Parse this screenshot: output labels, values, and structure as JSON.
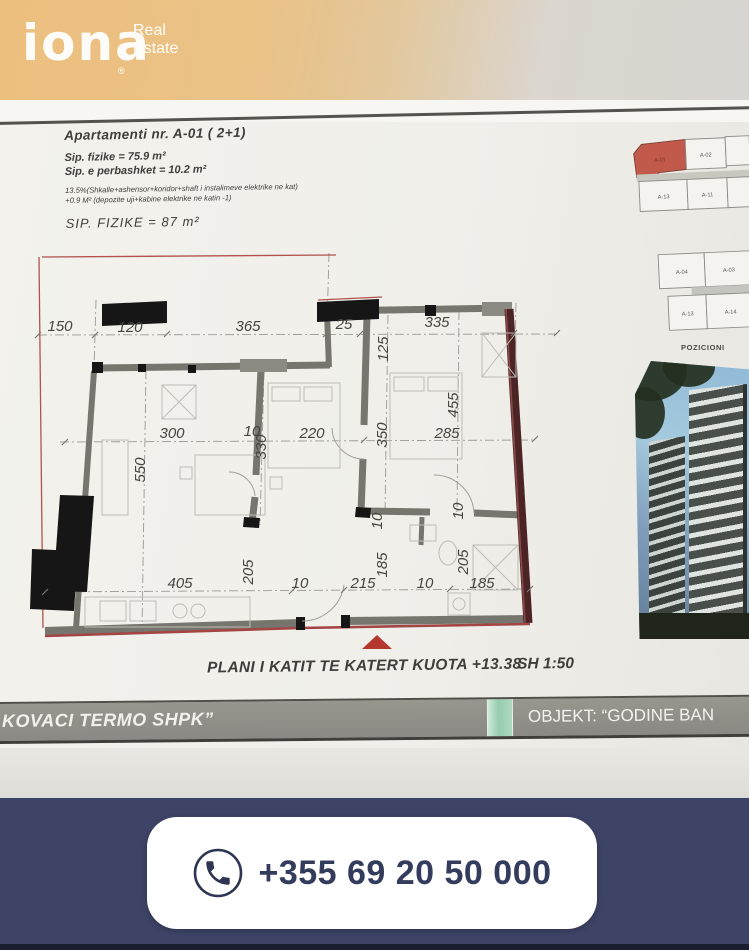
{
  "brand": {
    "logo": "iona",
    "reg": "®",
    "tag1": "Real",
    "tag2": "Estate"
  },
  "doc": {
    "header": {
      "title": "Apartamenti nr. A-01 ( 2+1)",
      "line1": "Sip. fizike =   75.9 m²",
      "line2": "Sip. e perbashket = 10.2 m²",
      "note1": "13.5%(Shkalle+ashensor+koridor+shaft i instalimeve elektrike ne kat)",
      "note2": "+0.9 M² (depozite uji+kabine elektrike ne katin -1)",
      "total": "SIP. FIZIKE = 87 m²"
    },
    "keyplan": {
      "label": "POZICIONI",
      "highlighted_unit": "A-01",
      "b1r1": [
        "A-01",
        "A-02"
      ],
      "b1r2": [
        "A-13",
        "A-11"
      ],
      "b2r1": [
        "A-04",
        "A-03"
      ],
      "b2r2": [
        "A-13",
        "A-14"
      ]
    },
    "plan": {
      "caption": "PLANI I KATIT TE KATERT KUOTA +13.38",
      "scale": "SH 1:50",
      "labels": [
        "150",
        "120",
        "365",
        "25",
        "335",
        "125",
        "455",
        "350",
        "330",
        "550",
        "205",
        "185",
        "205",
        "10",
        "10",
        "300",
        "10",
        "220",
        "285",
        "405",
        "10",
        "215",
        "10",
        "185"
      ]
    },
    "titlebar": {
      "left": "KOVACI TERMO SHPK”",
      "right": "OBJEKT: “GODINE BAN"
    }
  },
  "footer": {
    "phone": "+355 69 20 50 000"
  },
  "colors": {
    "accent_red": "#b5382e",
    "wall_maroon": "#4c2426",
    "navy": "#3e4466",
    "teal_stripe": "#96ccae",
    "highlight_unit": "#c15a4b"
  }
}
